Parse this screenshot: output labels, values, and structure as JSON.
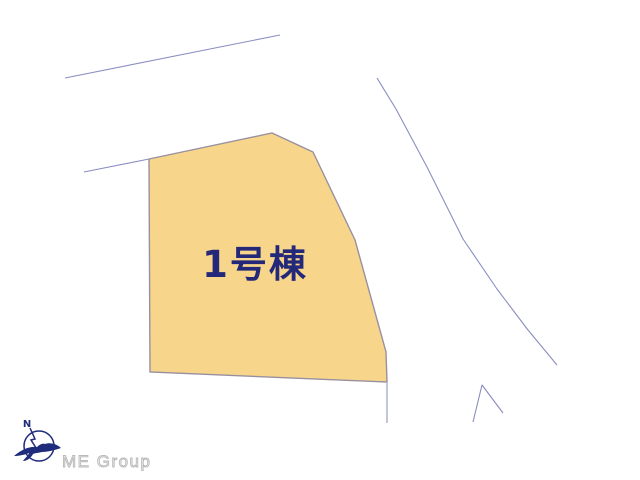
{
  "plan": {
    "parcel": {
      "label": "1号棟"
    },
    "colors": {
      "parcel_fill": "#F7D68C",
      "parcel_border": "#99909F",
      "road_line": "#8A8EC0",
      "label_text": "#232878"
    }
  },
  "logo": {
    "compass_letter": "N",
    "company": "ME Group",
    "brand_color": "#1F2B7B",
    "text_color": "#C8C8C8"
  }
}
